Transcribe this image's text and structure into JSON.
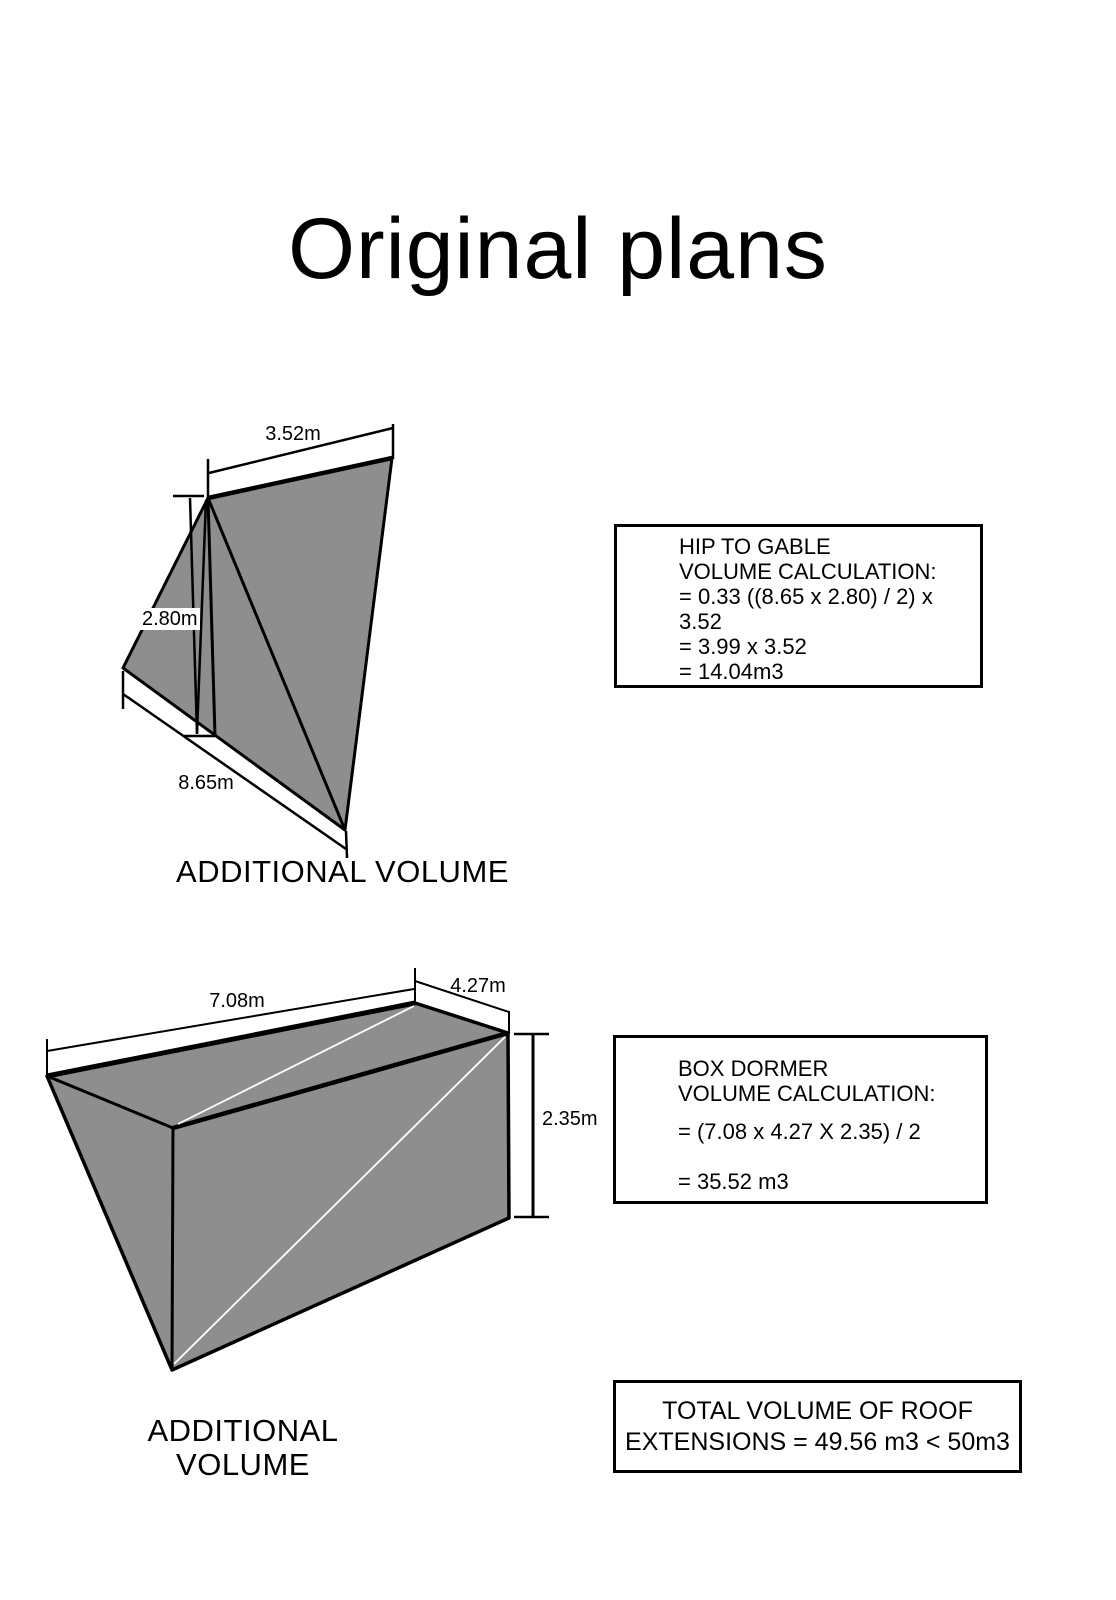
{
  "page": {
    "title": "Original plans"
  },
  "colors": {
    "shape_fill": "#8e8e8e",
    "stroke": "#000000",
    "fold_line": "#ffffff"
  },
  "hip_to_gable": {
    "caption": "ADDITIONAL VOLUME",
    "dim_top": "3.52m",
    "dim_height": "2.80m",
    "dim_bottom": "8.65m",
    "calc": {
      "heading_line1": "HIP TO GABLE",
      "heading_line2": "VOLUME CALCULATION:",
      "steps": [
        "= 0.33 ((8.65 x 2.80) / 2) x 3.52",
        "= 3.99 x 3.52",
        "= 14.04m3"
      ]
    }
  },
  "box_dormer": {
    "caption": "ADDITIONAL VOLUME",
    "dim_length": "7.08m",
    "dim_depth": "4.27m",
    "dim_height": "2.35m",
    "calc": {
      "heading_line1": "BOX DORMER",
      "heading_line2": "VOLUME CALCULATION:",
      "steps": [
        "= (7.08 x 4.27 X 2.35) / 2",
        "= 35.52 m3"
      ]
    }
  },
  "total": {
    "line1": "TOTAL VOLUME OF ROOF",
    "line2": "EXTENSIONS = 49.56 m3 < 50m3"
  }
}
